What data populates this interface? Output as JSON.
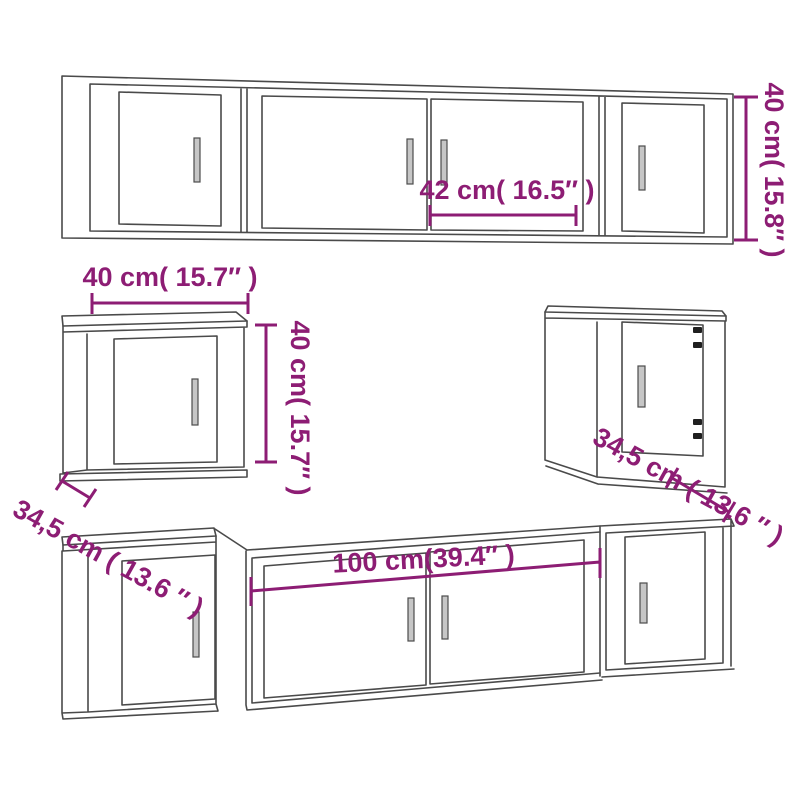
{
  "diagram": {
    "description": "Line drawing of a wall-mounted TV cabinet set (two long cabinet rows and two square side cabinets) with dimension annotations",
    "background_color": "#ffffff",
    "outline_color": "#4a4a4a",
    "dimension_color": "#8d1d74",
    "labels": {
      "top_row_door_width": "42 cm( 16.5″ )",
      "top_row_height": "40 cm( 15.8″ )",
      "square_cabinet_width": "40 cm( 15.7″ )",
      "square_cabinet_height": "40 cm( 15.7″ )",
      "square_cabinet_depth_left": "34,5 cm ( 13.6 ″ )",
      "square_cabinet_depth_right": "34,5 cm ( 13.6 ″ )",
      "bottom_row_width": "100 cm(39.4″ )"
    }
  }
}
